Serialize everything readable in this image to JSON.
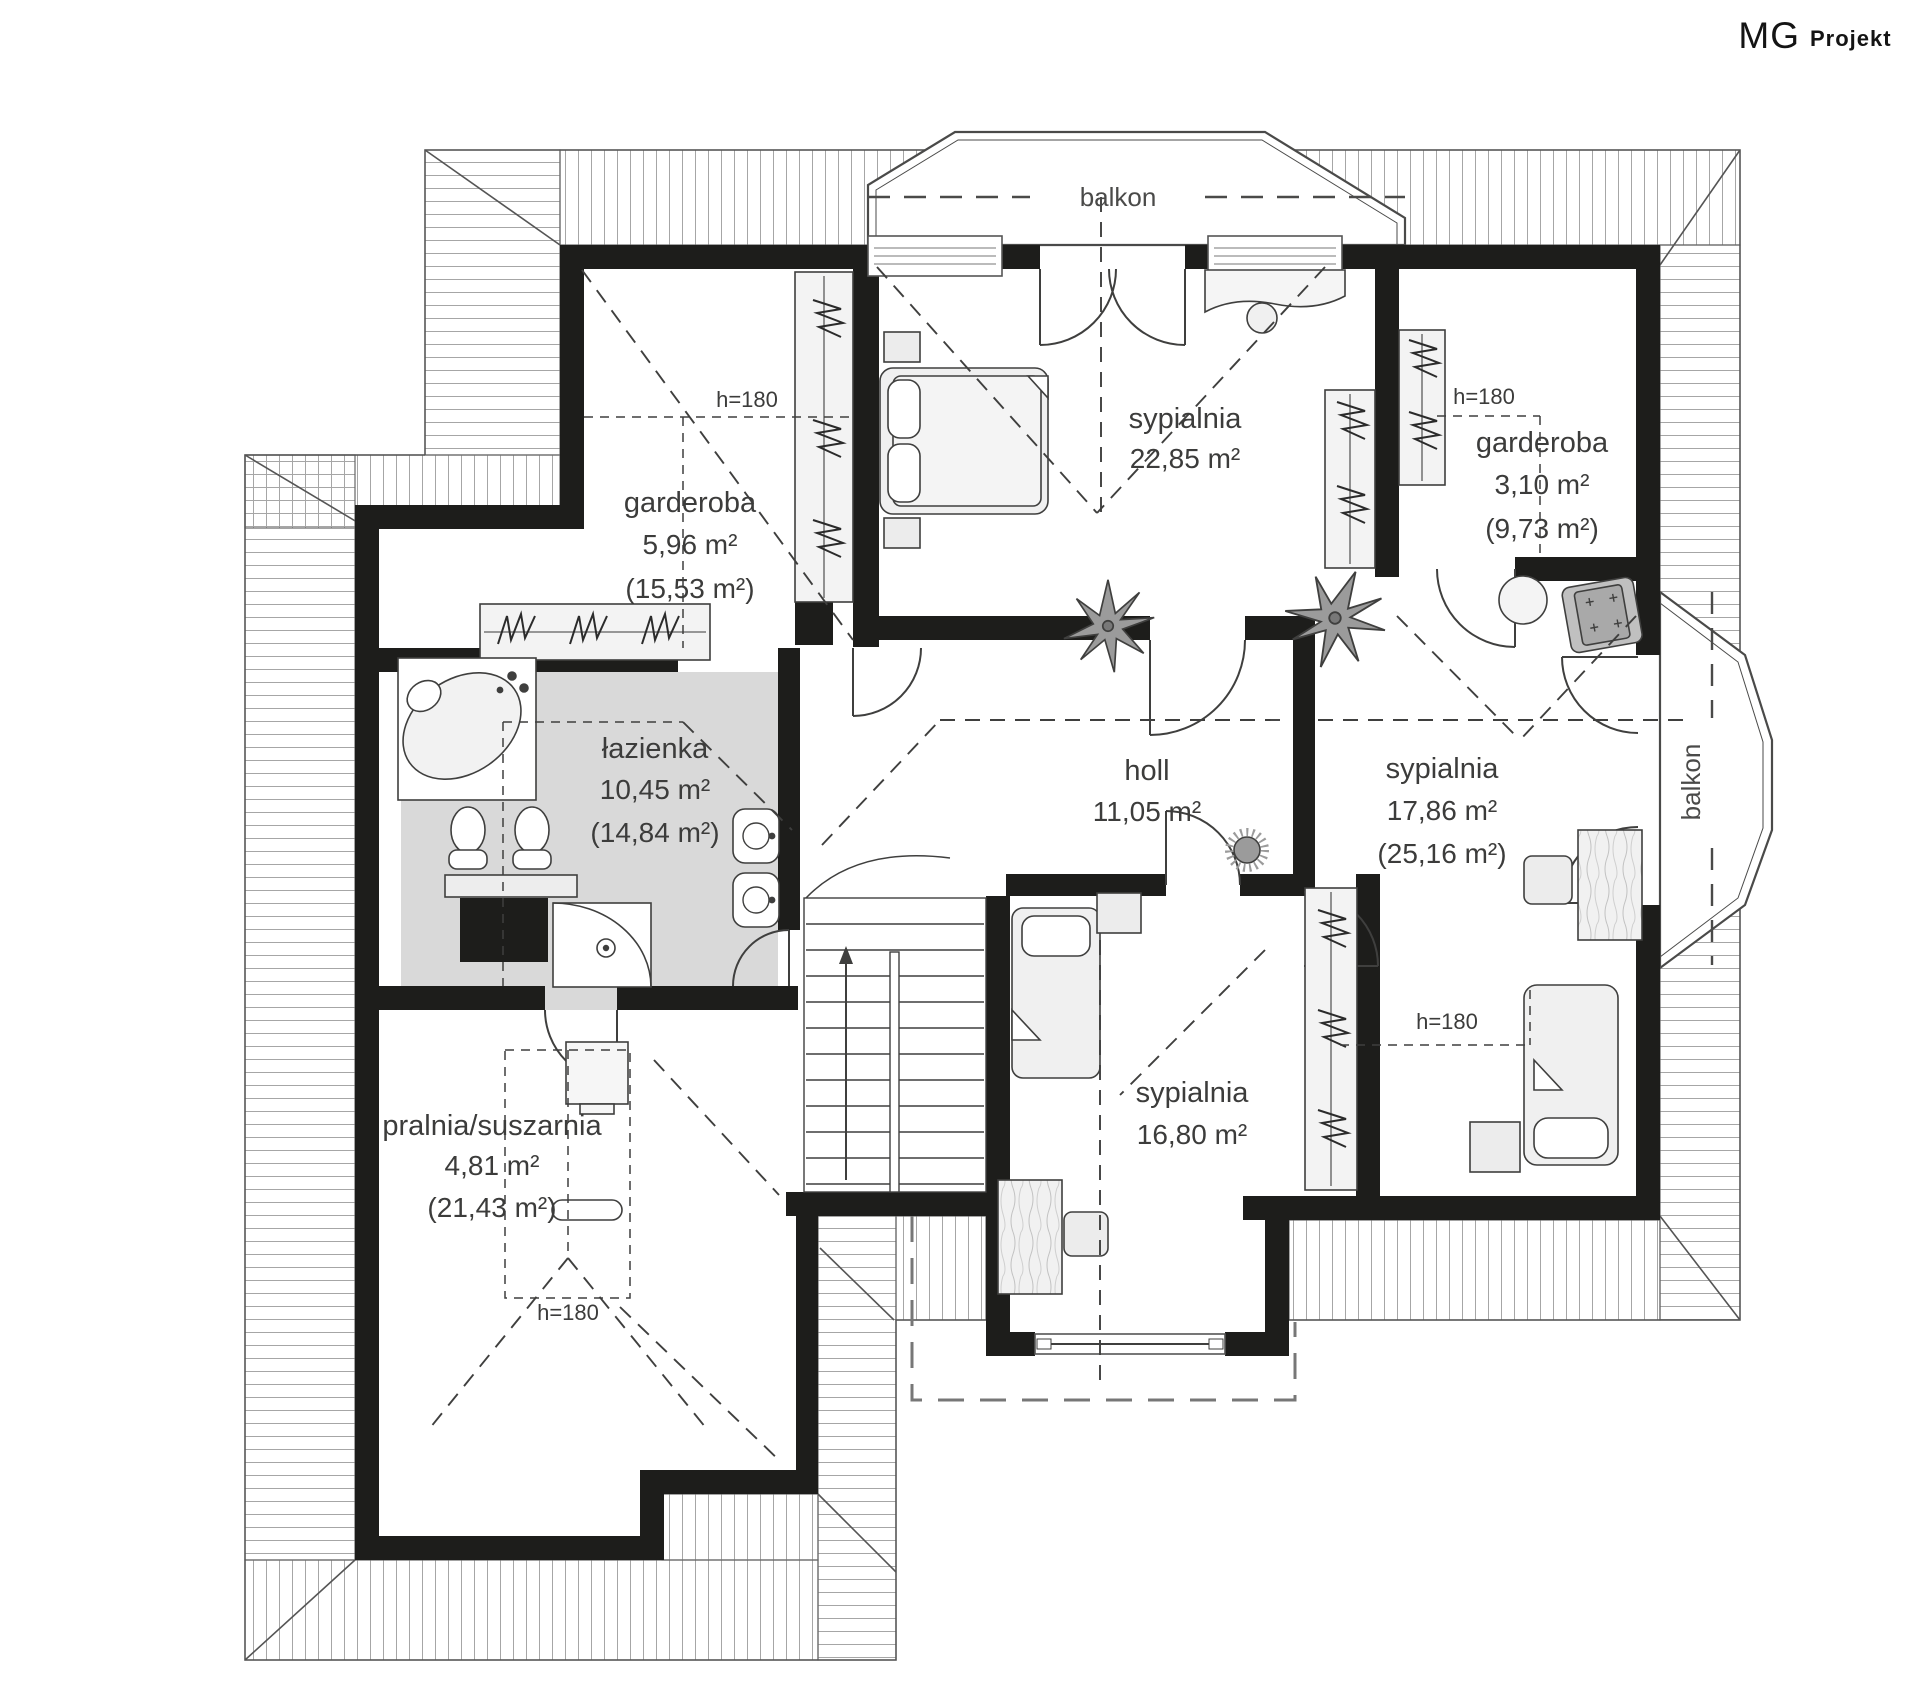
{
  "logo": {
    "mg": "MG",
    "projekt": "Projekt"
  },
  "balconies": {
    "top": "balkon",
    "right": "balkon"
  },
  "height_marker": "h=180",
  "rooms": {
    "garderoba1": {
      "name": "garderoba",
      "area": "5,96 m²",
      "total": "(15,53 m²)"
    },
    "sypialnia1": {
      "name": "sypialnia",
      "area": "22,85 m²"
    },
    "garderoba2": {
      "name": "garderoba",
      "area": "3,10 m²",
      "total": "(9,73 m²)"
    },
    "lazienka": {
      "name": "łazienka",
      "area": "10,45 m²",
      "total": "(14,84 m²)"
    },
    "holl": {
      "name": "holl",
      "area": "11,05 m²"
    },
    "sypialnia2": {
      "name": "sypialnia",
      "area": "17,86 m²",
      "total": "(25,16 m²)"
    },
    "sypialnia3": {
      "name": "sypialnia",
      "area": "16,80 m²"
    },
    "pralnia": {
      "name": "pralnia/suszarnia",
      "area": "4,81 m²",
      "total": "(21,43 m²)"
    }
  },
  "colors": {
    "wall": "#1d1d1b",
    "bath_floor": "#d9d9d9",
    "hatch": "#a6a6a6",
    "line": "#3f3f3e",
    "plant": "#9b9b9b"
  }
}
